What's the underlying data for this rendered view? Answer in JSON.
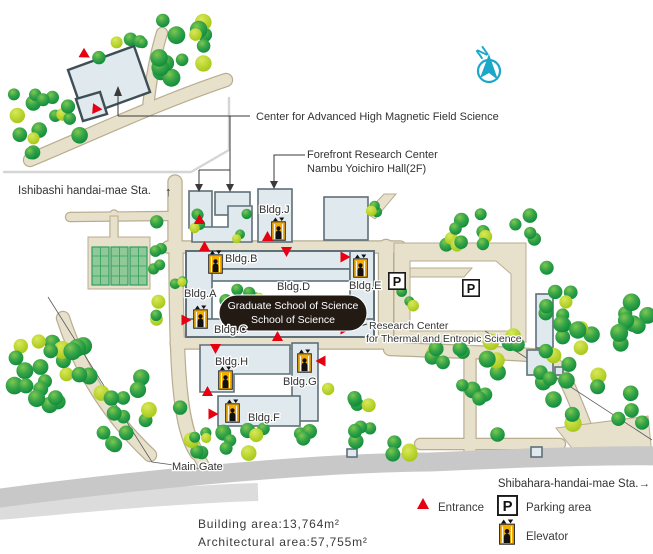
{
  "map": {
    "compass_n": "N",
    "stations": {
      "left": "Ishibashi handai-mae Sta.",
      "left_arrow": "↑",
      "right": "Shibahara-handai-mae Sta.→"
    },
    "callouts": {
      "magnetic": "Center for Advanced High Magnetic Field Science",
      "forefront1": "Forefront Research Center",
      "forefront2": "Nambu Yoichiro Hall(2F)",
      "research1": "Research Center",
      "research2": "for Thermal and Entropic Science"
    },
    "buildings": {
      "a": "Bldg.A",
      "b": "Bldg.B",
      "c": "Bldg.C",
      "d": "Bldg.D",
      "e": "Bldg.E",
      "f": "Bldg.F",
      "g": "Bldg.G",
      "h": "Bldg.H",
      "j": "Bldg.J"
    },
    "school_badge": {
      "line1": "Graduate School of Science",
      "line2": "School of Science"
    },
    "main_gate": "Main Gate"
  },
  "legend": {
    "entrance": "Entrance",
    "parking": "Parking area",
    "parking_letter": "P",
    "elevator": "Elevator"
  },
  "stats": {
    "building_area": "Building area:13,764m²",
    "architectural_area": "Architectural area:57,755m²"
  },
  "colors": {
    "road": "#e7e0cb",
    "road-edge": "#b9ad90",
    "building": "#dfe9ee",
    "building-edge": "#5f7078",
    "tree-dark": "#0d8a3a",
    "tree-mid": "#36a449",
    "tree-light": "#7fc84e",
    "tree-yellow": "#a3c614",
    "red": "#e60012",
    "orange": "#f6ab00",
    "teal": "#1ba7c9",
    "badge": "#241a14",
    "gray-road": "#c8c8c8",
    "gray-road-light": "#dcdcdc",
    "frame": "#d5d5d5",
    "text": "#333333"
  }
}
